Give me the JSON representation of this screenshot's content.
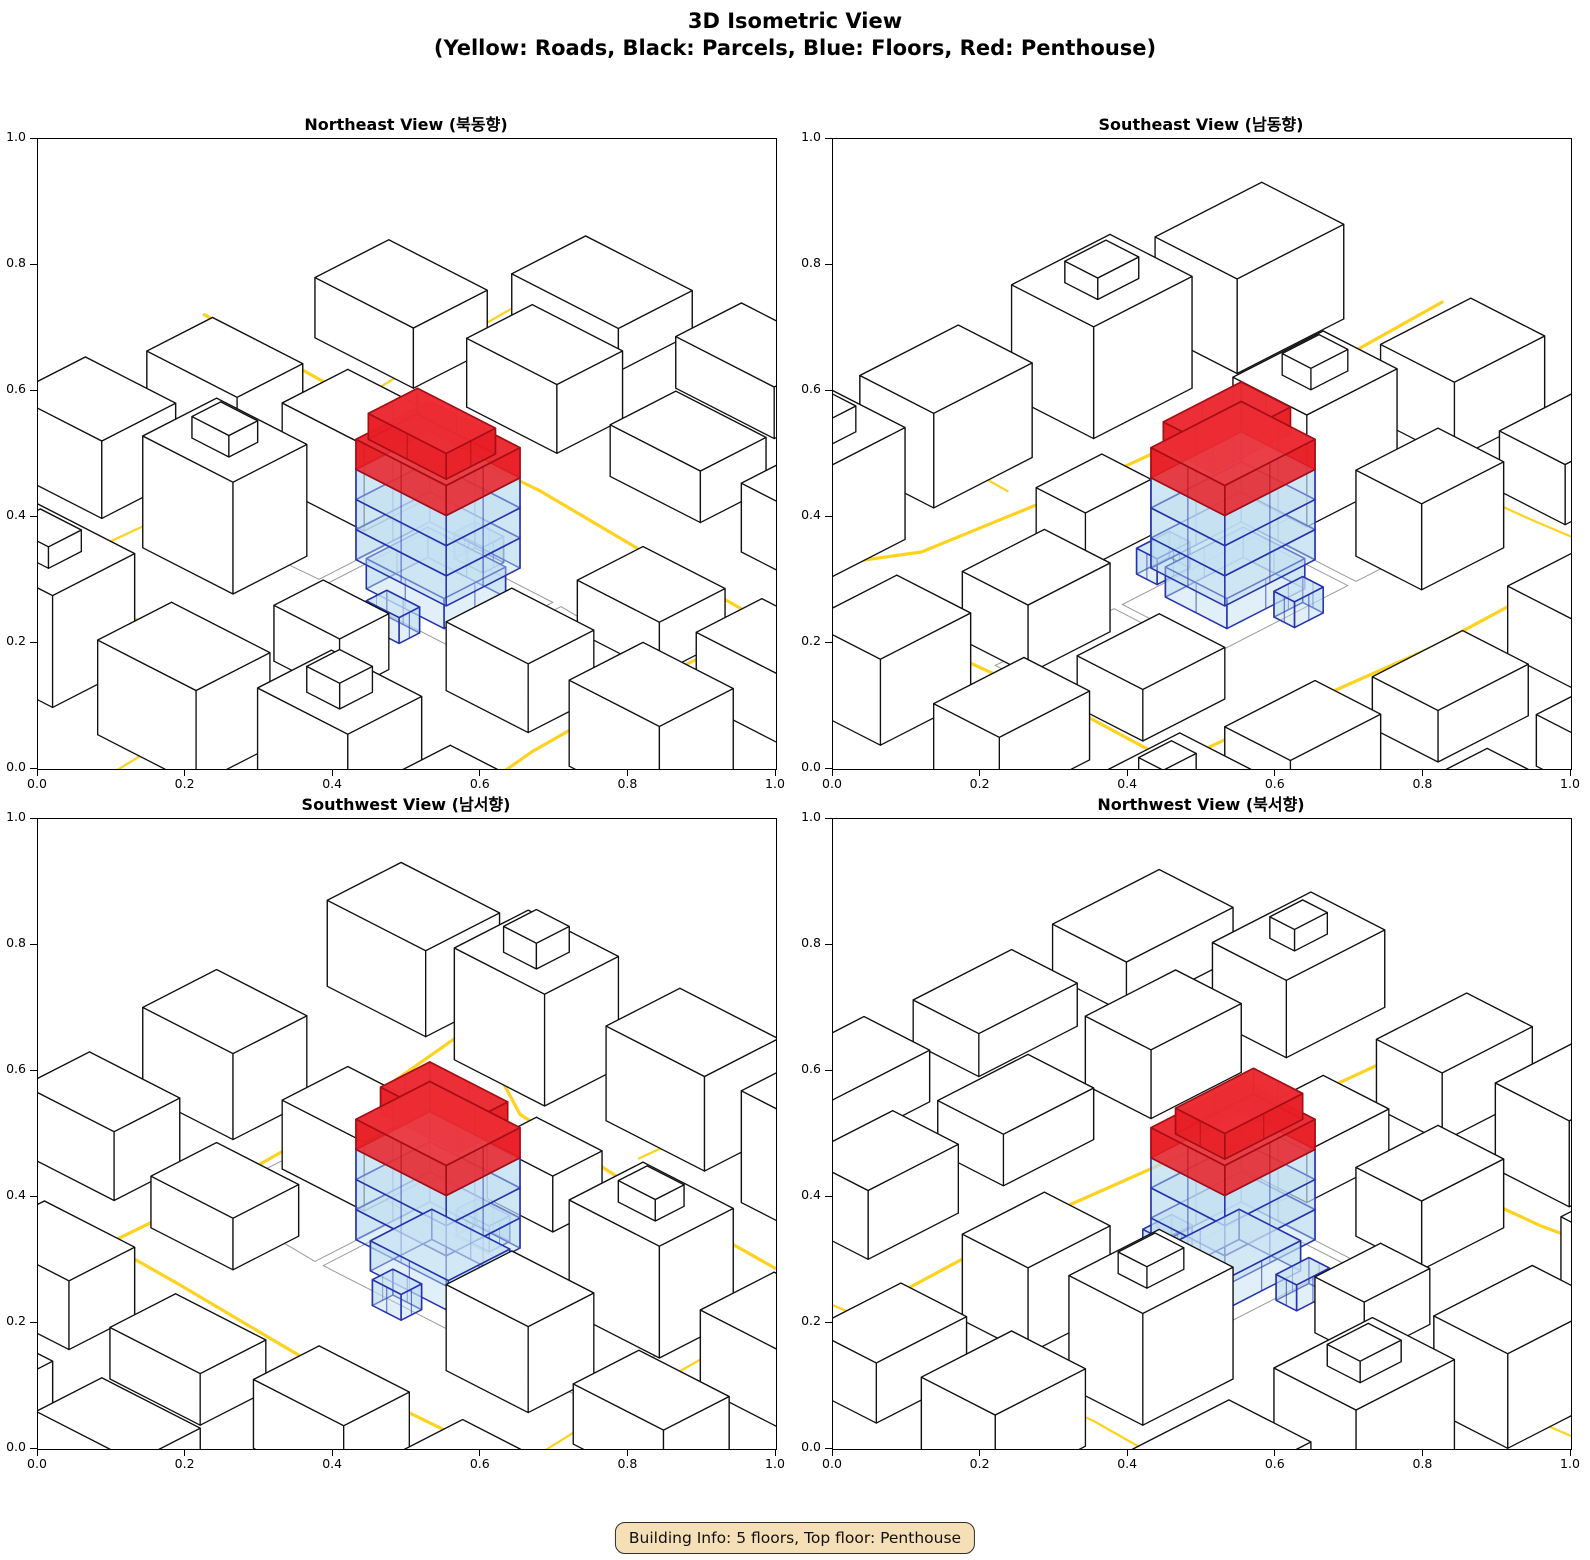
{
  "figure": {
    "title_line1": "3D Isometric View",
    "title_line2": "(Yellow: Roads, Black: Parcels, Blue: Floors, Red: Penthouse)"
  },
  "legend": {
    "roads": "Yellow",
    "parcels": "Black",
    "floors": "Blue",
    "penthouse": "Red"
  },
  "views": [
    {
      "id": "northeast",
      "title": "Northeast View (북동향)",
      "azimuth_deg": 45
    },
    {
      "id": "southeast",
      "title": "Southeast View (남동향)",
      "azimuth_deg": 135
    },
    {
      "id": "southwest",
      "title": "Southwest View (남서향)",
      "azimuth_deg": 225
    },
    {
      "id": "northwest",
      "title": "Northwest View (북서향)",
      "azimuth_deg": 315
    }
  ],
  "axes": {
    "range": [
      0.0,
      1.0
    ],
    "ticks": [
      "0.0",
      "0.2",
      "0.4",
      "0.6",
      "0.8",
      "1.0"
    ]
  },
  "badge": {
    "text": "Building Info: 5 floors, Top floor: Penthouse"
  },
  "building": {
    "floors": 5,
    "top_floor": "Penthouse"
  },
  "colors": {
    "road": "#FFD21E",
    "parcel_edge": "#111111",
    "parcel_ground": "#9a9a9a",
    "floor_fill": "#BBDBEF",
    "floor_edge": "#2633AD",
    "penthouse_fill": "#E81E26",
    "penthouse_edge": "#A50E14",
    "badge_bg": "#F5DFB7"
  }
}
